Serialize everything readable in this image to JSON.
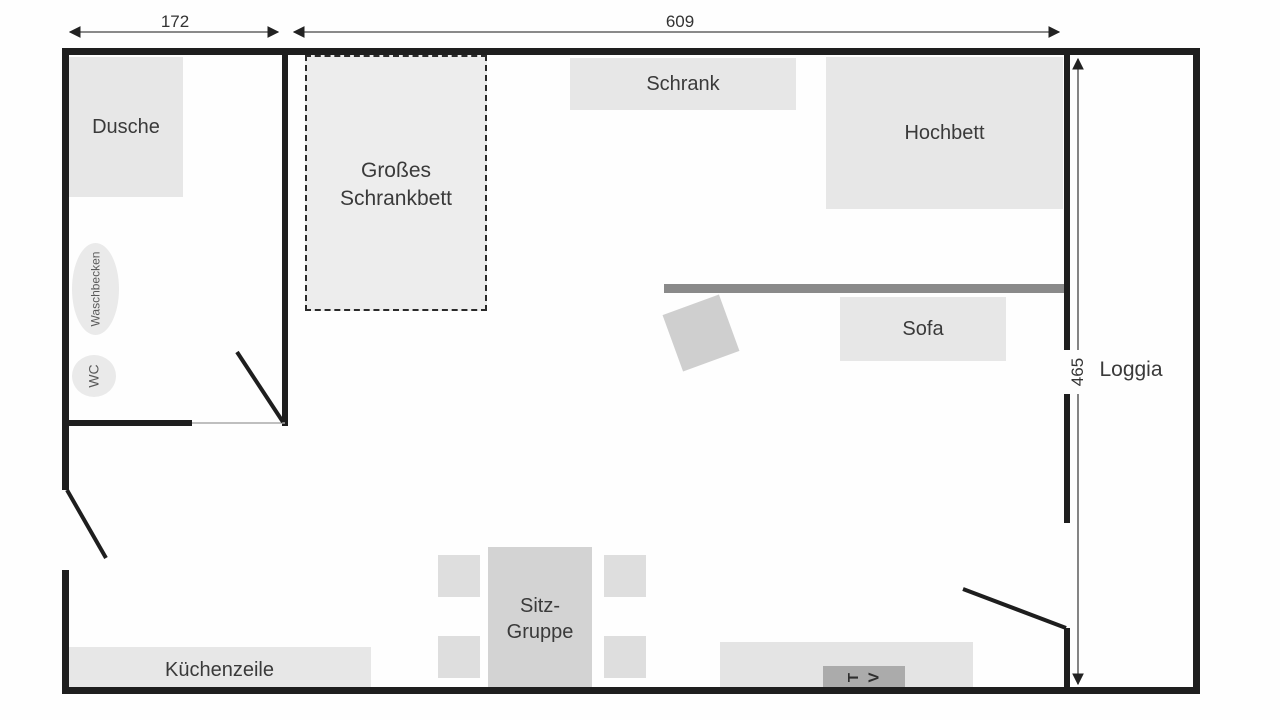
{
  "dimensions": {
    "bathroom_width": "172",
    "main_width": "609",
    "right_height": "465"
  },
  "rooms": {
    "shower": "Dusche",
    "sink": "Waschbecken",
    "toilet": "WC",
    "loggia": "Loggia"
  },
  "furniture": {
    "wardrobe": "Schrank",
    "loft_bed": "Hochbett",
    "cabinet_bed": "Großes Schrankbett",
    "sofa": "Sofa",
    "dining_set": "Sitz-Gruppe",
    "kitchenette": "Küchenzeile",
    "tv": "TV"
  },
  "colors": {
    "wall": "#1e1e1e",
    "furniture_fill": "#e7e7e7",
    "furniture_mid": "#d3d3d3",
    "divider_bar": "#8a8a8a"
  }
}
